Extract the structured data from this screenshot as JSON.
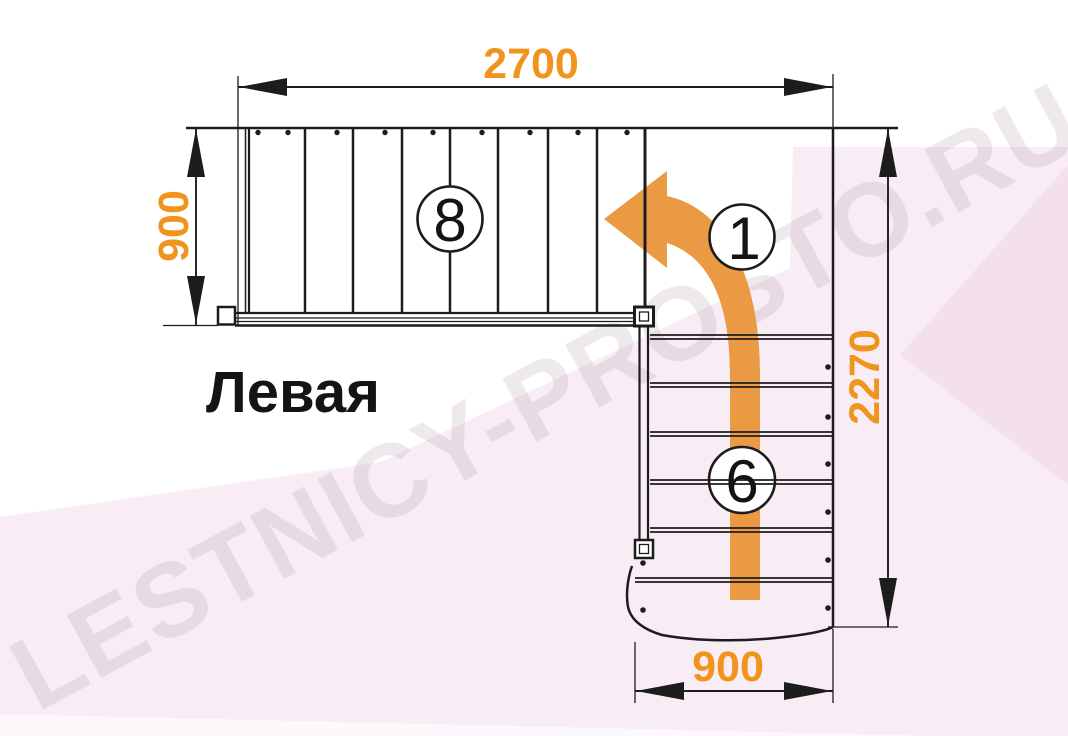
{
  "diagram": {
    "title": "Левая",
    "watermark": "LESTNICY-PROSTO.RU",
    "dimensions": {
      "top": "2700",
      "left": "900",
      "right": "2270",
      "bottom": "900"
    },
    "step_counts": {
      "upper_flight": "8",
      "turn_direction": "1",
      "lower_flight": "6"
    },
    "colors": {
      "dimension_orange": "#f1941d",
      "arrow_orange": "#e99a43",
      "line_black": "#1c1c1c",
      "background_pink": "#f8edf4",
      "background_pink_deep": "#f3e0ec",
      "watermark_gray": "rgba(152,118,140,0.16)"
    }
  }
}
